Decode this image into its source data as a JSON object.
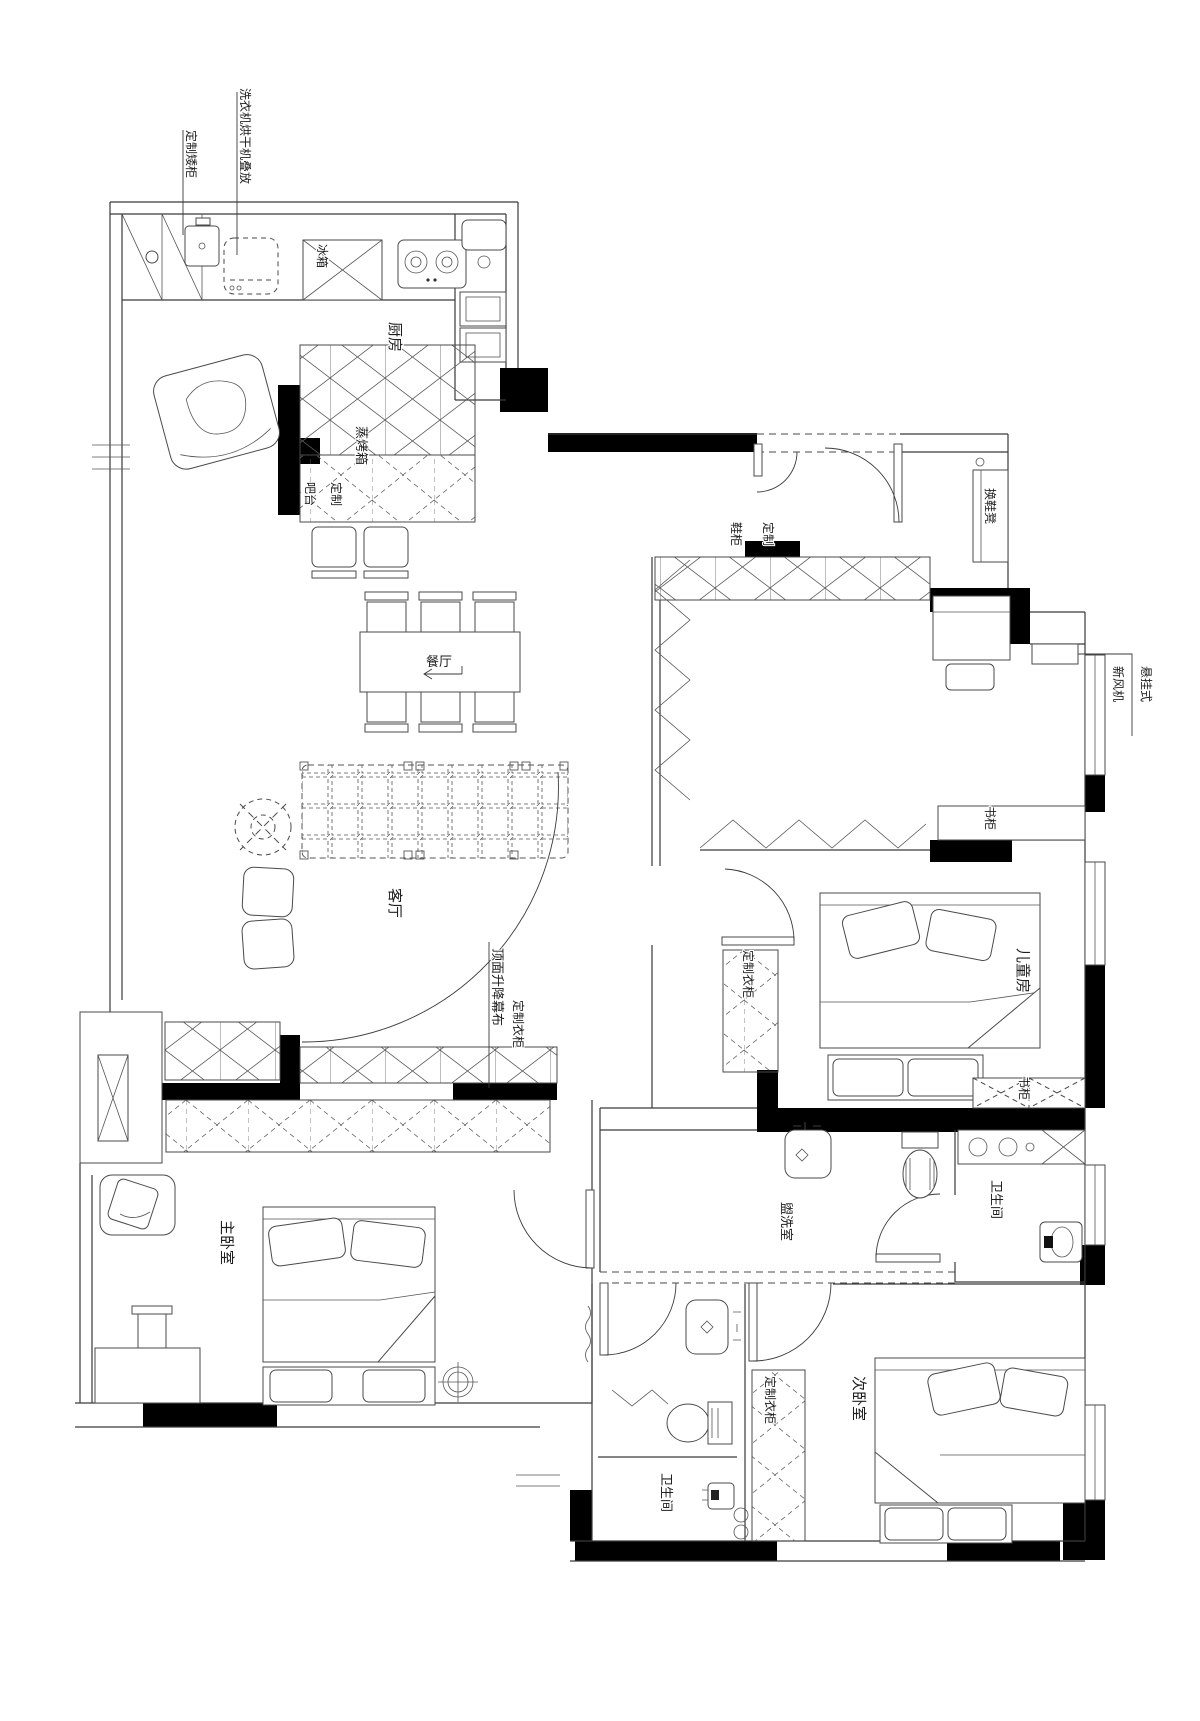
{
  "plan": {
    "rooms": {
      "kitchen": {
        "label": "厨房"
      },
      "dining": {
        "label": "餐厅"
      },
      "living": {
        "label": "客厅"
      },
      "kids_room": {
        "label": "儿童房"
      },
      "master_bedroom": {
        "label": "主卧室"
      },
      "washroom": {
        "label": "盥洗室"
      },
      "bathroom_east": {
        "label": "卫生间"
      },
      "bathroom_south": {
        "label": "卫生间"
      },
      "second_bedroom": {
        "label": "次卧室"
      }
    },
    "fixtures": {
      "custom_low_cabinet": {
        "label": "定制矮柜"
      },
      "washer_dryer": {
        "label": "洗衣机烘干机叠放"
      },
      "fridge": {
        "label": "冰箱"
      },
      "steam_oven": {
        "label": "蒸烤箱"
      },
      "custom_bar": {
        "cols": [
          "定制",
          "吧台"
        ]
      },
      "custom_shoe_cabinet": {
        "cols": [
          "定制",
          "鞋柜"
        ]
      },
      "shoe_bench": {
        "label": "换鞋凳"
      },
      "fresh_air_unit": {
        "cols": [
          "悬挂式",
          "新风机"
        ]
      },
      "bookcase_north": {
        "label": "书柜"
      },
      "bookcase_south": {
        "label": "书柜"
      },
      "wardrobe_hall": {
        "label": "定制衣柜"
      },
      "wardrobe_kids": {
        "label": "定制衣柜"
      },
      "wardrobe_second": {
        "label": "定制衣柜"
      },
      "ceiling_screen": {
        "label": "顶面升降幕布"
      }
    },
    "colors": {
      "line": "#3a3a3a",
      "wall": "#000000",
      "background": "#ffffff"
    }
  }
}
